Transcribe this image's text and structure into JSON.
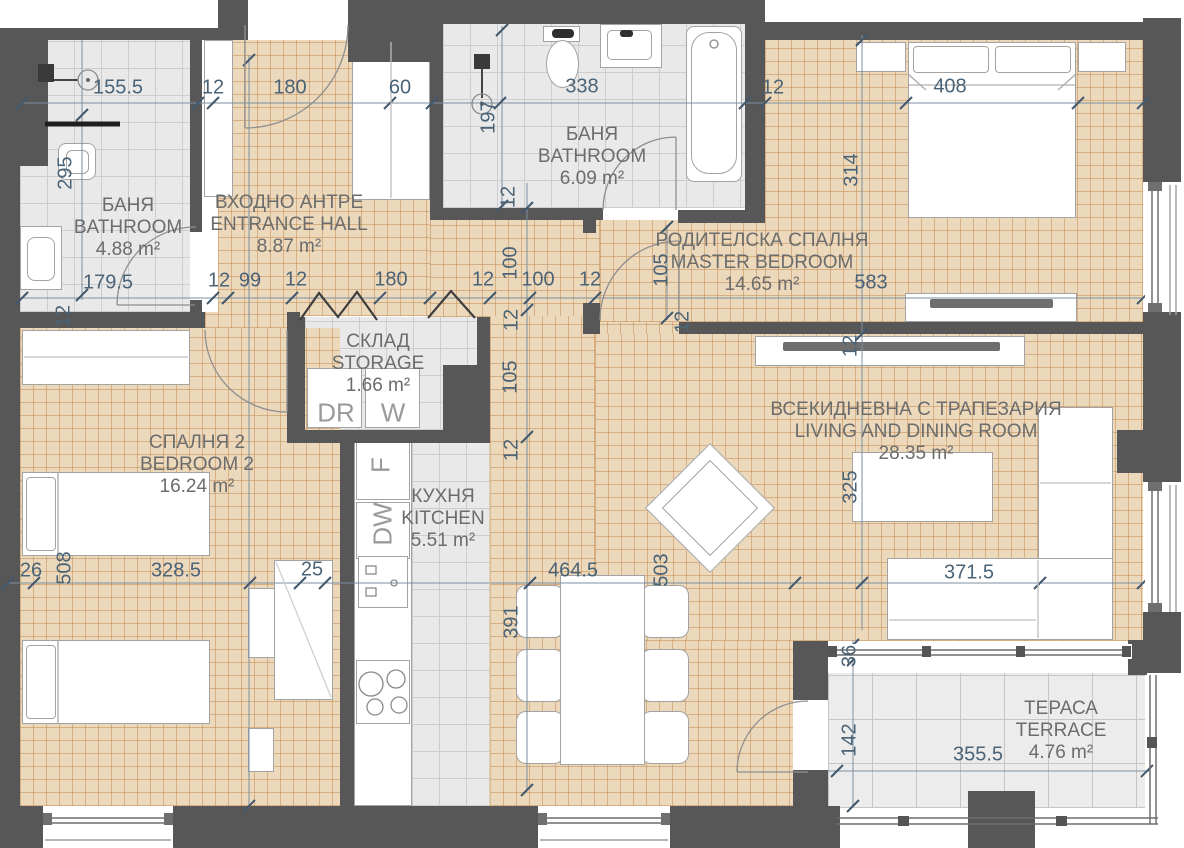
{
  "plan_title": "Apartment floor plan",
  "colors": {
    "wall": "#575757",
    "wood": "#ecd9bc",
    "wood_line": "rgba(186,124,64,0.45)",
    "tile": "#e9e9e9",
    "tile_line": "#cdcdcd",
    "terrace_tile": "#ececec",
    "terrace_tile_line": "#c6c6c6",
    "dimension_text": "#4b6377",
    "room_text": "#6c6c6c",
    "appliance_text": "#9a9a9a"
  },
  "rooms": [
    {
      "id": "bathroom-1",
      "name_bg": "БАНЯ",
      "name_en": "BATHROOM",
      "area": "4.88 m²",
      "cx": 128,
      "ty": 195
    },
    {
      "id": "entrance-hall",
      "name_bg": "ВХОДНО АНТРЕ",
      "name_en": "ENTRANCE HALL",
      "area": "8.87 m²",
      "cx": 289,
      "ty": 192
    },
    {
      "id": "bathroom-2",
      "name_bg": "БАНЯ",
      "name_en": "BATHROOM",
      "area": "6.09 m²",
      "cx": 592,
      "ty": 124
    },
    {
      "id": "master-bedroom",
      "name_bg": "РОДИТЕЛСКА СПАЛНЯ",
      "name_en": "MASTER BEDROOM",
      "area": "14.65 m²",
      "cx": 762,
      "ty": 230
    },
    {
      "id": "storage",
      "name_bg": "СКЛАД",
      "name_en": "STORAGE",
      "area": "1.66 m²",
      "cx": 378,
      "ty": 331
    },
    {
      "id": "bedroom-2",
      "name_bg": "СПАЛНЯ 2",
      "name_en": "BEDROOM 2",
      "area": "16.24 m²",
      "cx": 197,
      "ty": 432
    },
    {
      "id": "kitchen",
      "name_bg": "КУХНЯ",
      "name_en": "KITCHEN",
      "area": "5.51 m²",
      "cx": 443,
      "ty": 486
    },
    {
      "id": "living-dining",
      "name_bg": "ВСЕКИДНЕВНА С ТРАПЕЗАРИЯ",
      "name_en": "LIVING AND DINING ROOM",
      "area": "28.35 m²",
      "cx": 916,
      "ty": 399
    },
    {
      "id": "terrace",
      "name_bg": "ТЕРАСА",
      "name_en": "TERRACE",
      "area": "4.76 m²",
      "cx": 1061,
      "ty": 698
    }
  ],
  "appliances": [
    {
      "label": "DR",
      "x": 336,
      "y": 413,
      "vertical": false
    },
    {
      "label": "W",
      "x": 393,
      "y": 413,
      "vertical": false
    },
    {
      "label": "F",
      "x": 381,
      "y": 465,
      "vertical": true
    },
    {
      "label": "DW",
      "x": 383,
      "y": 524,
      "vertical": true
    }
  ],
  "dimensions": [
    {
      "text": "155.5",
      "x": 118,
      "y": 88,
      "vertical": false
    },
    {
      "text": "12",
      "x": 213,
      "y": 88,
      "vertical": false
    },
    {
      "text": "180",
      "x": 290,
      "y": 88,
      "vertical": false
    },
    {
      "text": "60",
      "x": 400,
      "y": 88,
      "vertical": false
    },
    {
      "text": "338",
      "x": 582,
      "y": 87,
      "vertical": false
    },
    {
      "text": "12",
      "x": 773,
      "y": 88,
      "vertical": false
    },
    {
      "text": "408",
      "x": 950,
      "y": 87,
      "vertical": false
    },
    {
      "text": "295",
      "x": 66,
      "y": 173,
      "vertical": true
    },
    {
      "text": "197",
      "x": 489,
      "y": 117,
      "vertical": true
    },
    {
      "text": "314",
      "x": 852,
      "y": 170,
      "vertical": true
    },
    {
      "text": "179.5",
      "x": 108,
      "y": 283,
      "vertical": false
    },
    {
      "text": "12",
      "x": 219,
      "y": 281,
      "vertical": false
    },
    {
      "text": "99",
      "x": 250,
      "y": 281,
      "vertical": false
    },
    {
      "text": "12",
      "x": 296,
      "y": 280,
      "vertical": false
    },
    {
      "text": "180",
      "x": 391,
      "y": 280,
      "vertical": false
    },
    {
      "text": "12",
      "x": 483,
      "y": 280,
      "vertical": false
    },
    {
      "text": "100",
      "x": 511,
      "y": 263,
      "vertical": true
    },
    {
      "text": "100",
      "x": 538,
      "y": 280,
      "vertical": false
    },
    {
      "text": "12",
      "x": 590,
      "y": 280,
      "vertical": false
    },
    {
      "text": "105",
      "x": 662,
      "y": 270,
      "vertical": true
    },
    {
      "text": "583",
      "x": 871,
      "y": 283,
      "vertical": false
    },
    {
      "text": "12",
      "x": 509,
      "y": 197,
      "vertical": true
    },
    {
      "text": "12",
      "x": 512,
      "y": 320,
      "vertical": true
    },
    {
      "text": "105",
      "x": 511,
      "y": 377,
      "vertical": true
    },
    {
      "text": "12",
      "x": 512,
      "y": 450,
      "vertical": true
    },
    {
      "text": "12",
      "x": 683,
      "y": 322,
      "vertical": true
    },
    {
      "text": "12",
      "x": 64,
      "y": 316,
      "vertical": true
    },
    {
      "text": "12",
      "x": 851,
      "y": 346,
      "vertical": true
    },
    {
      "text": "325",
      "x": 851,
      "y": 487,
      "vertical": true
    },
    {
      "text": "26",
      "x": 31,
      "y": 571,
      "vertical": false
    },
    {
      "text": "508",
      "x": 65,
      "y": 568,
      "vertical": true
    },
    {
      "text": "328.5",
      "x": 176,
      "y": 571,
      "vertical": false
    },
    {
      "text": "25",
      "x": 312,
      "y": 570,
      "vertical": false
    },
    {
      "text": "464.5",
      "x": 573,
      "y": 571,
      "vertical": false
    },
    {
      "text": "503",
      "x": 662,
      "y": 570,
      "vertical": true
    },
    {
      "text": "391",
      "x": 512,
      "y": 622,
      "vertical": true
    },
    {
      "text": "371.5",
      "x": 969,
      "y": 573,
      "vertical": false
    },
    {
      "text": "36",
      "x": 850,
      "y": 656,
      "vertical": true
    },
    {
      "text": "142",
      "x": 850,
      "y": 740,
      "vertical": true
    },
    {
      "text": "355.5",
      "x": 978,
      "y": 755,
      "vertical": false
    }
  ]
}
